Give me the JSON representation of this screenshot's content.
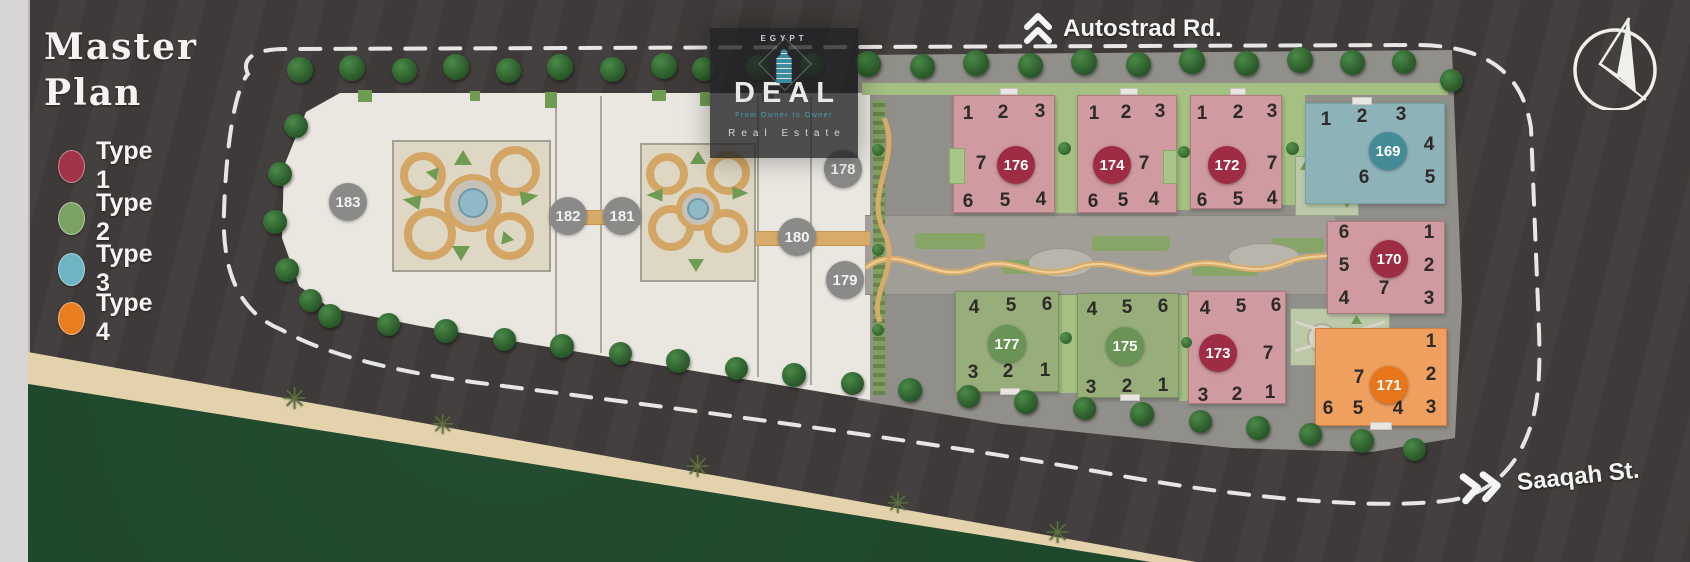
{
  "title": {
    "line1": "Master",
    "line2": "Plan"
  },
  "legend": {
    "items": [
      {
        "label": "Type 1",
        "color": "#a23349"
      },
      {
        "label": "Type 2",
        "color": "#7ca263"
      },
      {
        "label": "Type 3",
        "color": "#6db4c4"
      },
      {
        "label": "Type 4",
        "color": "#e87e1e"
      }
    ]
  },
  "roads": {
    "north": {
      "label": "Autostrad Rd."
    },
    "south": {
      "label": "Saaqah St."
    }
  },
  "logo": {
    "country": "EGYPT",
    "name": "DEAL",
    "tagline": "From Owner to Owner",
    "subtitle": "Real Estate"
  },
  "plan": {
    "colors": {
      "fill1": "#cf9aa0",
      "fill2": "#97ae7b",
      "fill3": "#8db3b9",
      "fill4": "#efa05f",
      "badge1": "#9e2c43",
      "badge2": "#6a9455",
      "badge3": "#438b97",
      "badge4": "#e8771c",
      "circle_gray": "#8a8a88"
    },
    "buildings": [
      {
        "id": "176",
        "type": 1,
        "rect": [
          953,
          95,
          102,
          118
        ],
        "badge": [
          1016,
          165
        ],
        "units": [
          [
            "1",
            968,
            116
          ],
          [
            "2",
            1003,
            115
          ],
          [
            "3",
            1040,
            114
          ],
          [
            "7",
            981,
            166
          ],
          [
            "6",
            968,
            204
          ],
          [
            "5",
            1005,
            203
          ],
          [
            "4",
            1041,
            202
          ]
        ]
      },
      {
        "id": "174",
        "type": 1,
        "rect": [
          1077,
          95,
          100,
          118
        ],
        "badge": [
          1112,
          165
        ],
        "units": [
          [
            "1",
            1094,
            116
          ],
          [
            "2",
            1126,
            115
          ],
          [
            "3",
            1160,
            114
          ],
          [
            "7",
            1144,
            166
          ],
          [
            "6",
            1093,
            204
          ],
          [
            "5",
            1123,
            203
          ],
          [
            "4",
            1154,
            202
          ]
        ]
      },
      {
        "id": "172",
        "type": 1,
        "rect": [
          1190,
          95,
          92,
          114
        ],
        "badge": [
          1227,
          165
        ],
        "units": [
          [
            "1",
            1202,
            116
          ],
          [
            "2",
            1238,
            115
          ],
          [
            "3",
            1272,
            114
          ],
          [
            "7",
            1272,
            166
          ],
          [
            "6",
            1202,
            203
          ],
          [
            "5",
            1238,
            202
          ],
          [
            "4",
            1272,
            201
          ]
        ]
      },
      {
        "id": "169",
        "type": 3,
        "rect": [
          1305,
          103,
          140,
          101
        ],
        "badge": [
          1388,
          151
        ],
        "units": [
          [
            "1",
            1326,
            122
          ],
          [
            "2",
            1362,
            119
          ],
          [
            "3",
            1401,
            117
          ],
          [
            "4",
            1429,
            147
          ],
          [
            "6",
            1364,
            180
          ],
          [
            "5",
            1430,
            180
          ]
        ]
      },
      {
        "id": "170",
        "type": 1,
        "rect": [
          1327,
          221,
          118,
          93
        ],
        "badge": [
          1389,
          259
        ],
        "units": [
          [
            "6",
            1344,
            235
          ],
          [
            "5",
            1344,
            268
          ],
          [
            "4",
            1344,
            301
          ],
          [
            "1",
            1429,
            235
          ],
          [
            "2",
            1429,
            268
          ],
          [
            "3",
            1429,
            301
          ],
          [
            "7",
            1384,
            291
          ]
        ]
      },
      {
        "id": "171",
        "type": 4,
        "rect": [
          1315,
          328,
          132,
          98
        ],
        "badge": [
          1389,
          385
        ],
        "units": [
          [
            "1",
            1431,
            344
          ],
          [
            "2",
            1431,
            377
          ],
          [
            "3",
            1431,
            410
          ],
          [
            "7",
            1359,
            380
          ],
          [
            "6",
            1328,
            411
          ],
          [
            "5",
            1358,
            411
          ],
          [
            "4",
            1398,
            411
          ]
        ]
      },
      {
        "id": "173",
        "type": 1,
        "rect": [
          1188,
          291,
          98,
          113
        ],
        "badge": [
          1218,
          353
        ],
        "units": [
          [
            "4",
            1205,
            311
          ],
          [
            "5",
            1241,
            309
          ],
          [
            "6",
            1276,
            308
          ],
          [
            "7",
            1268,
            356
          ],
          [
            "3",
            1203,
            398
          ],
          [
            "2",
            1237,
            397
          ],
          [
            "1",
            1270,
            395
          ]
        ]
      },
      {
        "id": "177",
        "type": 2,
        "rect": [
          955,
          291,
          104,
          101
        ],
        "badge": [
          1007,
          344
        ],
        "units": [
          [
            "4",
            974,
            310
          ],
          [
            "5",
            1011,
            308
          ],
          [
            "6",
            1047,
            307
          ],
          [
            "3",
            973,
            375
          ],
          [
            "2",
            1008,
            374
          ],
          [
            "1",
            1045,
            373
          ]
        ]
      },
      {
        "id": "175",
        "type": 2,
        "rect": [
          1077,
          293,
          102,
          105
        ],
        "badge": [
          1125,
          346
        ],
        "units": [
          [
            "4",
            1092,
            312
          ],
          [
            "5",
            1127,
            310
          ],
          [
            "6",
            1163,
            309
          ],
          [
            "3",
            1091,
            390
          ],
          [
            "2",
            1127,
            389
          ],
          [
            "1",
            1163,
            388
          ]
        ]
      }
    ],
    "site_circles": [
      {
        "label": "183",
        "x": 348,
        "y": 202
      },
      {
        "label": "182",
        "x": 568,
        "y": 216
      },
      {
        "label": "181",
        "x": 622,
        "y": 216
      },
      {
        "label": "180",
        "x": 797,
        "y": 237
      },
      {
        "label": "179",
        "x": 845,
        "y": 280
      },
      {
        "label": "178",
        "x": 843,
        "y": 169
      }
    ]
  }
}
